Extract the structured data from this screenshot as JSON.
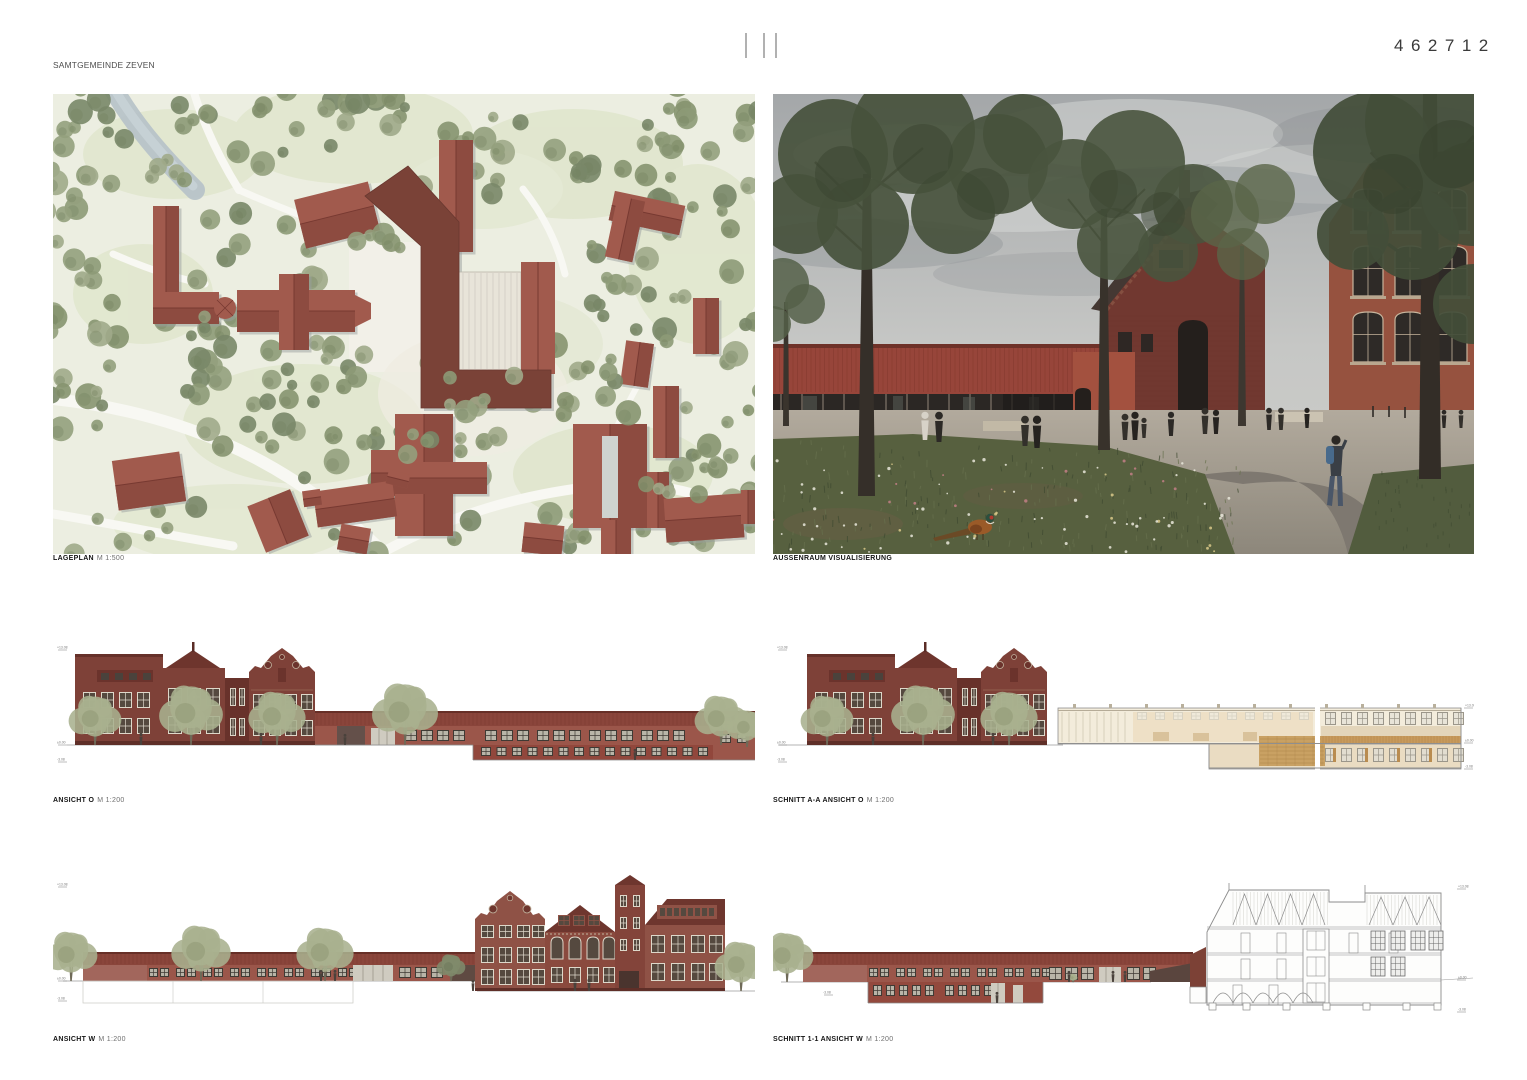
{
  "header": {
    "lines": [
      "SAMTGEMEINDE ZEVEN",
      "HOCHBAULICHER REALISIERUNGSWETTBEWERB",
      "\"KULTUR- UND BILDUNGSZENTRUM KLOSTERGANG, ZEVEN (KUBIZ)",
      "IN DER EHEMALIGEN GRUNDSCHULE KLOSTERGANG\""
    ]
  },
  "entry_code": "462712",
  "panels": {
    "site_plan": {
      "label": "LAGEPLAN",
      "scale": "M 1:500"
    },
    "visualization": {
      "label": "AUSSENRAUM VISUALISIERUNG",
      "scale": ""
    },
    "elevation_o": {
      "label": "ANSICHT O",
      "scale": "M 1:200"
    },
    "section_aa": {
      "label": "SCHNITT A-A ANSICHT O",
      "scale": "M 1:200"
    },
    "elevation_w": {
      "label": "ANSICHT W",
      "scale": "M 1:200"
    },
    "section_11": {
      "label": "SCHNITT 1-1 ANSICHT W",
      "scale": "M 1:200"
    }
  },
  "datum_marks": {
    "top": "+13.08",
    "zero": "±0.00",
    "low": "-3.08"
  },
  "colors": {
    "brick_red": "#9b564a",
    "dark_brick": "#7e4138",
    "new_building_red": "#7a4237",
    "plan_tree_green": "#94a07d",
    "render_tree_green": "#47523d",
    "sky_gray": "#b5b8b6",
    "section_beige": "#ecdcc0",
    "meadow_green": "#57603f"
  }
}
